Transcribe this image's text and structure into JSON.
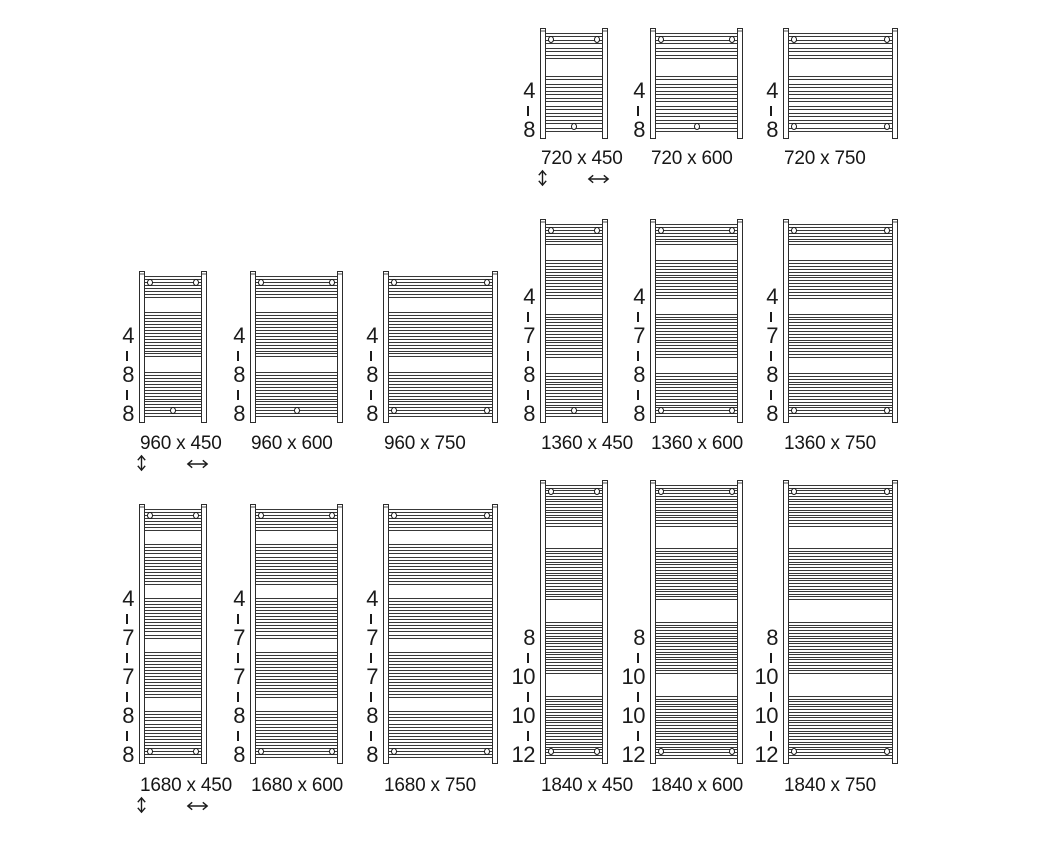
{
  "diagram": {
    "kind": "towel-radiator-size-chart",
    "background_color": "#ffffff",
    "line_color": "#2d2d2d",
    "text_color": "#161616",
    "size_label_separator": " x ",
    "icons": {
      "height_arrow": "updown-double-arrow",
      "width_arrow": "leftright-double-arrow"
    },
    "radiators": [
      {
        "label": "720 x 450",
        "height_mm": 720,
        "width_mm": 450,
        "bar_groups": [
          4,
          8
        ],
        "bottom_brackets": "center",
        "show_size_arrows": true
      },
      {
        "label": "720 x 600",
        "height_mm": 720,
        "width_mm": 600,
        "bar_groups": [
          4,
          8
        ],
        "bottom_brackets": "center",
        "show_size_arrows": false
      },
      {
        "label": "720 x 750",
        "height_mm": 720,
        "width_mm": 750,
        "bar_groups": [
          4,
          8
        ],
        "bottom_brackets": "sides",
        "show_size_arrows": false
      },
      {
        "label": "960 x 450",
        "height_mm": 960,
        "width_mm": 450,
        "bar_groups": [
          4,
          8,
          8
        ],
        "bottom_brackets": "center",
        "show_size_arrows": true
      },
      {
        "label": "960 x 600",
        "height_mm": 960,
        "width_mm": 600,
        "bar_groups": [
          4,
          8,
          8
        ],
        "bottom_brackets": "center",
        "show_size_arrows": false
      },
      {
        "label": "960 x 750",
        "height_mm": 960,
        "width_mm": 750,
        "bar_groups": [
          4,
          8,
          8
        ],
        "bottom_brackets": "sides",
        "show_size_arrows": false
      },
      {
        "label": "1360 x 450",
        "height_mm": 1360,
        "width_mm": 450,
        "bar_groups": [
          4,
          7,
          8,
          8
        ],
        "bottom_brackets": "center",
        "show_size_arrows": false
      },
      {
        "label": "1360 x 600",
        "height_mm": 1360,
        "width_mm": 600,
        "bar_groups": [
          4,
          7,
          8,
          8
        ],
        "bottom_brackets": "sides",
        "show_size_arrows": false
      },
      {
        "label": "1360 x 750",
        "height_mm": 1360,
        "width_mm": 750,
        "bar_groups": [
          4,
          7,
          8,
          8
        ],
        "bottom_brackets": "sides",
        "show_size_arrows": false
      },
      {
        "label": "1680 x 450",
        "height_mm": 1680,
        "width_mm": 450,
        "bar_groups": [
          4,
          7,
          7,
          8,
          8
        ],
        "bottom_brackets": "sides",
        "show_size_arrows": true
      },
      {
        "label": "1680 x 600",
        "height_mm": 1680,
        "width_mm": 600,
        "bar_groups": [
          4,
          7,
          7,
          8,
          8
        ],
        "bottom_brackets": "sides",
        "show_size_arrows": false
      },
      {
        "label": "1680 x 750",
        "height_mm": 1680,
        "width_mm": 750,
        "bar_groups": [
          4,
          7,
          7,
          8,
          8
        ],
        "bottom_brackets": "sides",
        "show_size_arrows": false
      },
      {
        "label": "1840 x 450",
        "height_mm": 1840,
        "width_mm": 450,
        "bar_groups": [
          8,
          10,
          10,
          12
        ],
        "bottom_brackets": "sides",
        "show_size_arrows": false
      },
      {
        "label": "1840 x 600",
        "height_mm": 1840,
        "width_mm": 600,
        "bar_groups": [
          8,
          10,
          10,
          12
        ],
        "bottom_brackets": "sides",
        "show_size_arrows": false
      },
      {
        "label": "1840 x 750",
        "height_mm": 1840,
        "width_mm": 750,
        "bar_groups": [
          8,
          10,
          10,
          12
        ],
        "bottom_brackets": "sides",
        "show_size_arrows": false
      }
    ]
  }
}
